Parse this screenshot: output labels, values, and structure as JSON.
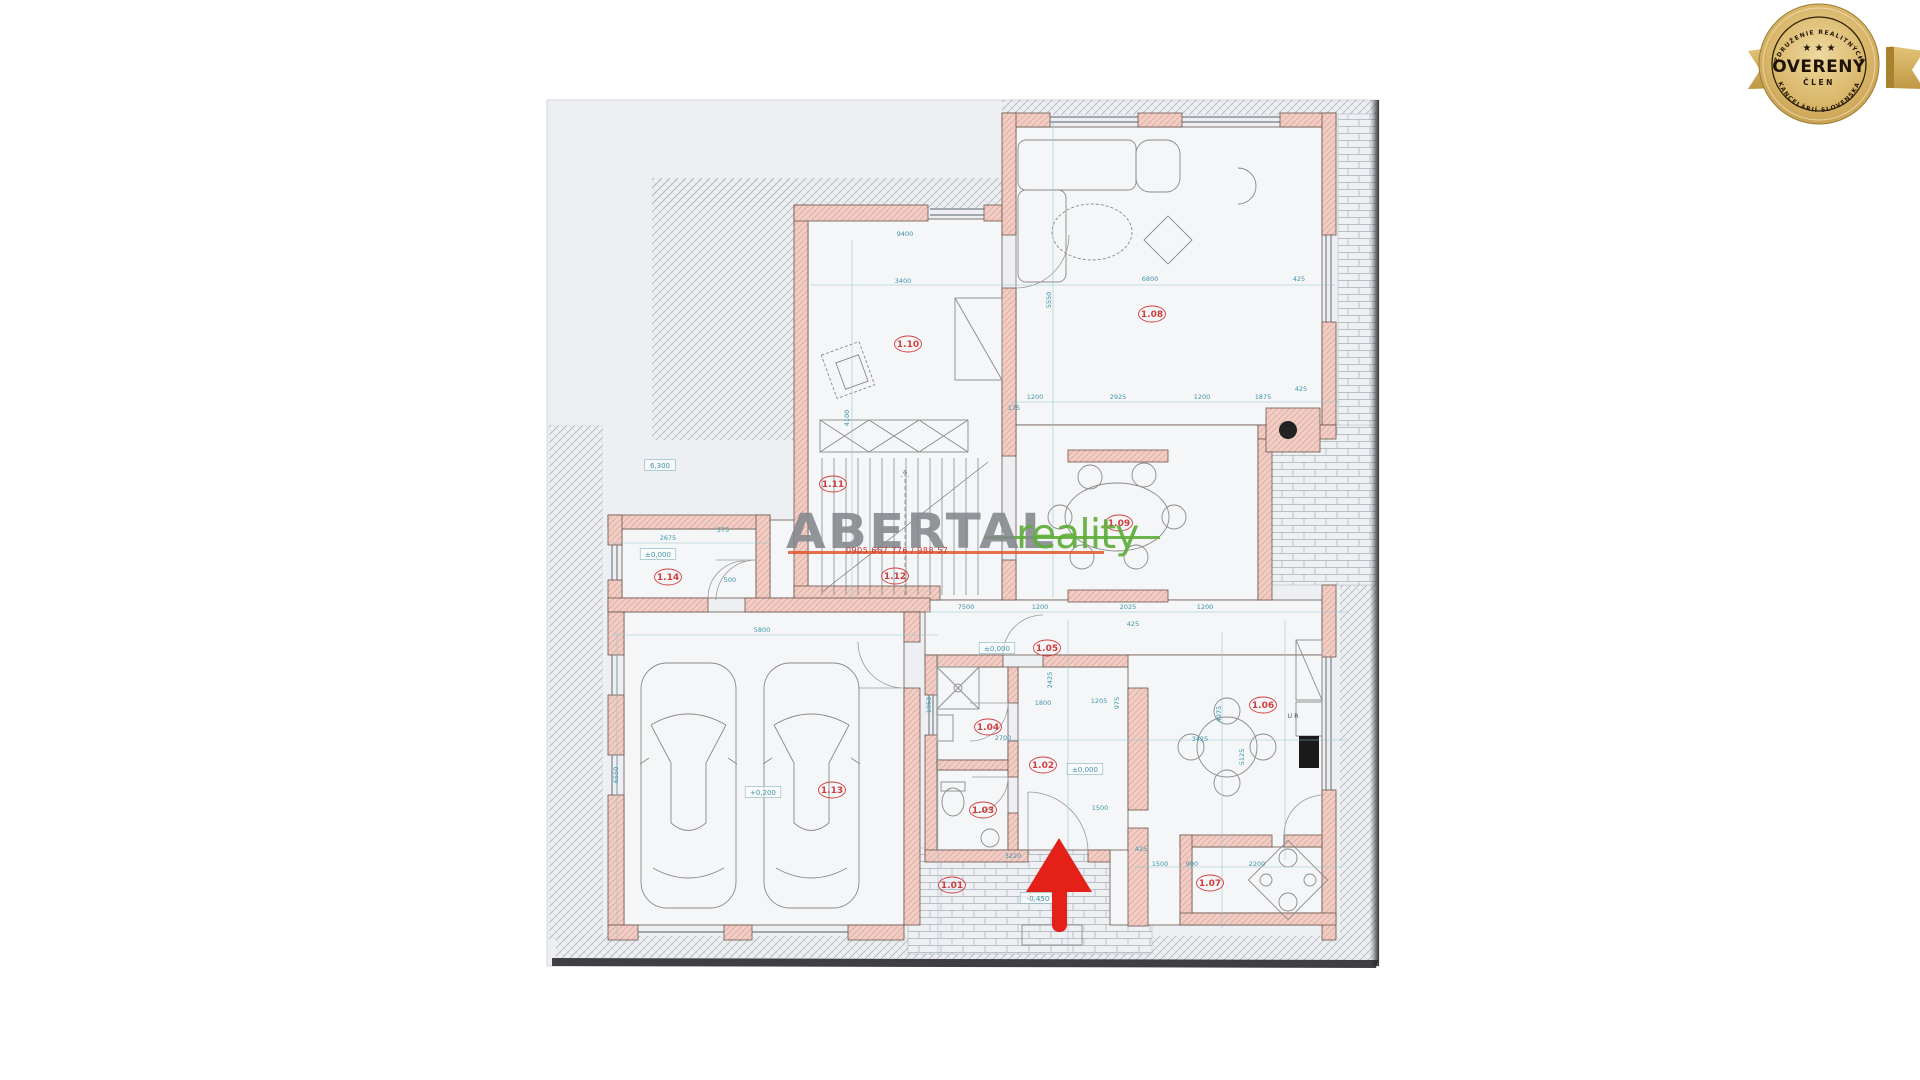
{
  "page": {
    "background": "#ffffff",
    "paper_color": "#edeff2"
  },
  "badge": {
    "arc_top": "ZDRUŽENIE REALITNÝCH",
    "arc_bottom": "KANCELÁRIÍ SLOVENSKA",
    "stars": "★ ★ ★",
    "title": "OVERENÝ",
    "subtitle": "ČLEN",
    "gold": "#c9a24f"
  },
  "watermark": {
    "part1": "ABERTAL",
    "part2": "reality",
    "phone": "0905 667 776 / 988 57",
    "gray": "#84888c",
    "green": "#5fae3a",
    "underline_orange": "#e2572d"
  },
  "arrow": {
    "color": "#e32119"
  },
  "plan": {
    "colors": {
      "wall_fill": "#f2cdc5",
      "wall_line": "#6a564c",
      "dimension": "#3d95aa",
      "room_label": "#cf3e3e",
      "hatch": "#a6abb2"
    },
    "room_labels": [
      {
        "id": "1.01",
        "x": 952,
        "y": 888
      },
      {
        "id": "1.02",
        "x": 1043,
        "y": 768
      },
      {
        "id": "1.03",
        "x": 983,
        "y": 813
      },
      {
        "id": "1.04",
        "x": 988,
        "y": 730
      },
      {
        "id": "1.05",
        "x": 1047,
        "y": 651
      },
      {
        "id": "1.06",
        "x": 1263,
        "y": 708
      },
      {
        "id": "1.07",
        "x": 1210,
        "y": 886
      },
      {
        "id": "1.08",
        "x": 1152,
        "y": 317
      },
      {
        "id": "1.09",
        "x": 1119,
        "y": 526
      },
      {
        "id": "1.10",
        "x": 908,
        "y": 347
      },
      {
        "id": "1.11",
        "x": 833,
        "y": 487
      },
      {
        "id": "1.12",
        "x": 895,
        "y": 579
      },
      {
        "id": "1.13",
        "x": 832,
        "y": 793
      },
      {
        "id": "1.14",
        "x": 668,
        "y": 580
      }
    ],
    "level_marks": [
      {
        "text": "6,300",
        "x": 660,
        "y": 468
      },
      {
        "text": "±0,000",
        "x": 658,
        "y": 557
      },
      {
        "text": "+0,200",
        "x": 763,
        "y": 795
      },
      {
        "text": "±0,000",
        "x": 997,
        "y": 651
      },
      {
        "text": "±0,000",
        "x": 1085,
        "y": 772
      },
      {
        "text": "-0,450",
        "x": 1038,
        "y": 901
      }
    ],
    "dimensions": [
      {
        "text": "9400",
        "x": 905,
        "y": 236
      },
      {
        "text": "3400",
        "x": 903,
        "y": 283
      },
      {
        "text": "6800",
        "x": 1150,
        "y": 281
      },
      {
        "text": "425",
        "x": 1299,
        "y": 281
      },
      {
        "text": "5550",
        "x": 1051,
        "y": 300,
        "v": 1
      },
      {
        "text": "4100",
        "x": 849,
        "y": 418,
        "v": 1
      },
      {
        "text": "1200",
        "x": 1035,
        "y": 399
      },
      {
        "text": "2925",
        "x": 1118,
        "y": 399
      },
      {
        "text": "1200",
        "x": 1202,
        "y": 399
      },
      {
        "text": "1875",
        "x": 1263,
        "y": 399
      },
      {
        "text": "425",
        "x": 1301,
        "y": 391
      },
      {
        "text": "175",
        "x": 1014,
        "y": 410
      },
      {
        "text": "2675",
        "x": 668,
        "y": 540
      },
      {
        "text": "575",
        "x": 723,
        "y": 532
      },
      {
        "text": "500",
        "x": 730,
        "y": 582
      },
      {
        "text": "5800",
        "x": 762,
        "y": 632
      },
      {
        "text": "6550",
        "x": 618,
        "y": 775,
        "v": 1
      },
      {
        "text": "7500",
        "x": 966,
        "y": 609
      },
      {
        "text": "1200",
        "x": 1040,
        "y": 609
      },
      {
        "text": "2025",
        "x": 1128,
        "y": 609
      },
      {
        "text": "1200",
        "x": 1205,
        "y": 609
      },
      {
        "text": "425",
        "x": 1133,
        "y": 626
      },
      {
        "text": "2700",
        "x": 1003,
        "y": 740
      },
      {
        "text": "1800",
        "x": 1043,
        "y": 705
      },
      {
        "text": "1205",
        "x": 1099,
        "y": 703
      },
      {
        "text": "975",
        "x": 1119,
        "y": 703,
        "v": 1
      },
      {
        "text": "2425",
        "x": 1052,
        "y": 680,
        "v": 1
      },
      {
        "text": "1950",
        "x": 931,
        "y": 705,
        "v": 1
      },
      {
        "text": "1500",
        "x": 1100,
        "y": 810
      },
      {
        "text": "3425",
        "x": 1200,
        "y": 741
      },
      {
        "text": "4975",
        "x": 1221,
        "y": 714,
        "v": 1
      },
      {
        "text": "5125",
        "x": 1244,
        "y": 757,
        "v": 1
      },
      {
        "text": "2200",
        "x": 1257,
        "y": 866
      },
      {
        "text": "1500",
        "x": 1160,
        "y": 866
      },
      {
        "text": "900",
        "x": 1192,
        "y": 866
      },
      {
        "text": "425",
        "x": 1141,
        "y": 851
      },
      {
        "text": "3220",
        "x": 1013,
        "y": 858
      }
    ],
    "annotations": [
      {
        "text": "U R",
        "x": 1293,
        "y": 718
      }
    ]
  }
}
